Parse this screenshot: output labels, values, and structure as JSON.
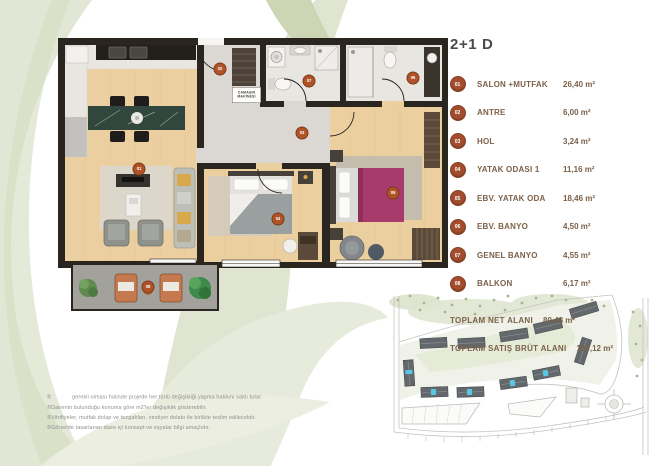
{
  "title": "2+1 D",
  "legend": {
    "rooms": [
      {
        "num": "01",
        "label": "SALON +MUTFAK",
        "value": "26,40 m²"
      },
      {
        "num": "02",
        "label": "ANTRE",
        "value": "6,00 m²"
      },
      {
        "num": "03",
        "label": "HOL",
        "value": "3,24 m²"
      },
      {
        "num": "04",
        "label": "YATAK ODASI 1",
        "value": "11,16 m²"
      },
      {
        "num": "05",
        "label": "EBV. YATAK ODA",
        "value": "18,46 m²"
      },
      {
        "num": "06",
        "label": "EBV. BANYO",
        "value": "4,50 m²"
      },
      {
        "num": "07",
        "label": "GENEL BANYO",
        "value": "4,55 m²"
      },
      {
        "num": "08",
        "label": "BALKON",
        "value": "6,17 m²"
      }
    ],
    "totals": [
      {
        "label": "TOPLAM NET  ALANI",
        "value": "80,48  m²"
      },
      {
        "label": "TOPLAM SATIŞ BRÜT ALANI",
        "value": "120,12 m²"
      }
    ]
  },
  "plan": {
    "washer_label": "ÇAMAŞIR\nMAKİNESİ"
  },
  "disclaimer": {
    "lines": [
      "®             gerekli olması halinde projede her türlü değişikliği yapma hakkını saklı tutar.",
      "®Dairenin bulunduğu konuma göre m2'ler değişiklik gösterebilir.",
      "®Vitrifiyeler, mutfak dolap ve tezgahları, vestiyer dolabı ile birlikte teslim edilecektir.",
      "®Görselde tasarlanan daire içi konsept ve eşyalar bilgi amaçlıdır."
    ]
  },
  "colors": {
    "accent_badge": "#a24e2e",
    "wall": "#2b2520",
    "wood_floor": "#ebcf9e",
    "watermark_green": "#e1e6d4",
    "site_highlight": "#59c8e6",
    "master_bed_blanket": "#a63a6b"
  }
}
